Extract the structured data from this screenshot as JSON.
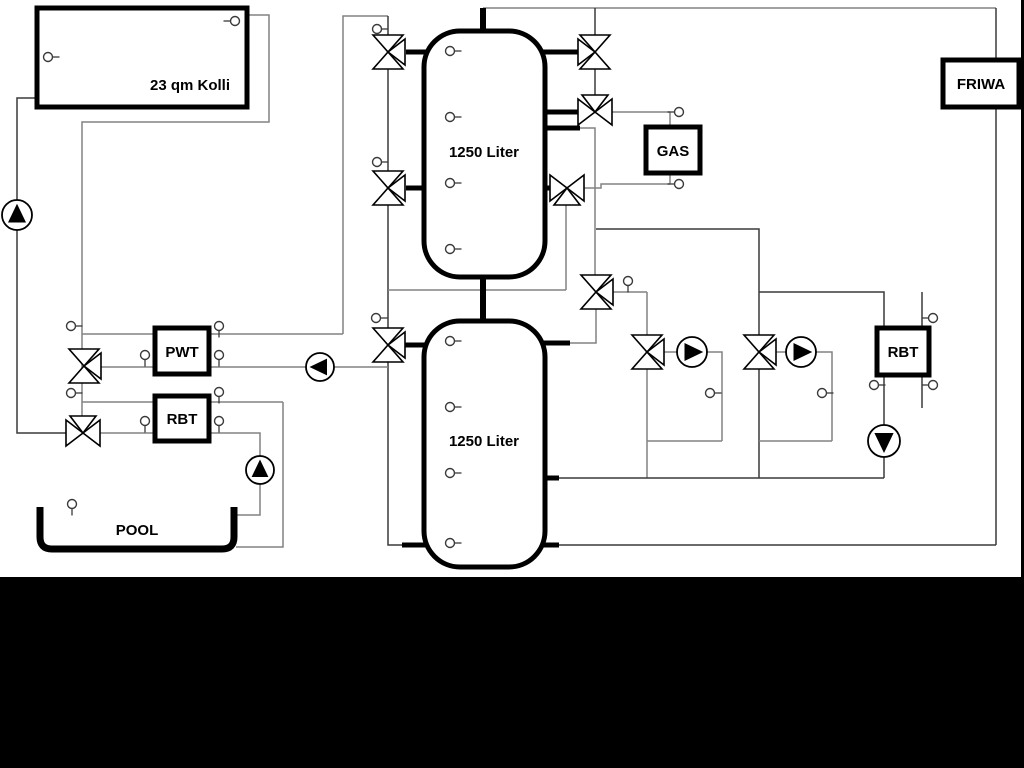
{
  "diagram_title": "Heating system hydraulic schematic",
  "colors": {
    "pipe_gray": "#828282",
    "pipe_dark": "#3a3a3a",
    "black": "#000000",
    "white": "#ffffff"
  },
  "frame": {
    "width": 1024,
    "height": 768,
    "black_band_y": 577,
    "right_strip_x": 1021,
    "right_strip_w": 3
  },
  "boxes": [
    {
      "id": "collector",
      "label": "23 qm Kolli",
      "x": 37,
      "y": 8,
      "w": 210,
      "h": 99,
      "rx": 0,
      "sw": 5,
      "lx": 190,
      "ly": 90,
      "fs": 15
    },
    {
      "id": "tank-upper",
      "label": "1250 Liter",
      "x": 424,
      "y": 31,
      "w": 121,
      "h": 246,
      "rx": 36,
      "sw": 5,
      "lx": 484,
      "ly": 157,
      "fs": 15
    },
    {
      "id": "tank-lower",
      "label": "1250 Liter",
      "x": 424,
      "y": 321,
      "w": 121,
      "h": 246,
      "rx": 36,
      "sw": 5,
      "lx": 484,
      "ly": 446,
      "fs": 15
    },
    {
      "id": "pwt",
      "label": "PWT",
      "x": 155,
      "y": 328,
      "w": 54,
      "h": 46,
      "rx": 0,
      "sw": 5,
      "lx": 182,
      "ly": 357,
      "fs": 15
    },
    {
      "id": "rbt-left",
      "label": "RBT",
      "x": 155,
      "y": 396,
      "w": 54,
      "h": 45,
      "rx": 0,
      "sw": 5,
      "lx": 182,
      "ly": 424,
      "fs": 15
    },
    {
      "id": "gas",
      "label": "GAS",
      "x": 646,
      "y": 127,
      "w": 54,
      "h": 46,
      "rx": 0,
      "sw": 5,
      "lx": 673,
      "ly": 156,
      "fs": 15
    },
    {
      "id": "rbt-right",
      "label": "RBT",
      "x": 877,
      "y": 328,
      "w": 52,
      "h": 47,
      "rx": 0,
      "sw": 5,
      "lx": 903,
      "ly": 357,
      "fs": 15
    },
    {
      "id": "friwa",
      "label": "FRIWA",
      "x": 943,
      "y": 60,
      "w": 76,
      "h": 47,
      "rx": 0,
      "sw": 5,
      "lx": 981,
      "ly": 89,
      "fs": 15
    }
  ],
  "pool": {
    "label": "POOL",
    "x1": 40,
    "x2": 234,
    "top": 507,
    "bottom": 549,
    "r": 12,
    "sw": 7,
    "lx": 137,
    "ly": 535,
    "fs": 15
  },
  "pipes": [
    {
      "name": "solar-return-riser",
      "pts": [
        [
          37,
          98
        ],
        [
          17,
          98
        ],
        [
          17,
          433
        ],
        [
          66,
          433
        ]
      ],
      "c": "d",
      "w": 1.5
    },
    {
      "name": "solar-flow-drop",
      "pts": [
        [
          247,
          15
        ],
        [
          269,
          15
        ],
        [
          269,
          122
        ],
        [
          82,
          122
        ],
        [
          82,
          416
        ]
      ],
      "c": "g",
      "w": 1.5
    },
    {
      "name": "pwt-top-line",
      "pts": [
        [
          82,
          334
        ],
        [
          343,
          334
        ]
      ],
      "c": "g",
      "w": 1.5
    },
    {
      "name": "tank-left-riser",
      "pts": [
        [
          343,
          334
        ],
        [
          343,
          16
        ],
        [
          388,
          16
        ]
      ],
      "c": "g",
      "w": 1.5
    },
    {
      "name": "tank-left-manifold",
      "pts": [
        [
          388,
          16
        ],
        [
          388,
          545
        ],
        [
          403,
          545
        ]
      ],
      "c": "d",
      "w": 1.5
    },
    {
      "name": "pwt-bottom-line",
      "pts": [
        [
          101,
          367
        ],
        [
          388,
          367
        ]
      ],
      "c": "g",
      "w": 1.5
    },
    {
      "name": "rbt-left-top-line",
      "pts": [
        [
          82,
          402
        ],
        [
          283,
          402
        ]
      ],
      "c": "g",
      "w": 1.5
    },
    {
      "name": "pool-return-line",
      "pts": [
        [
          283,
          402
        ],
        [
          283,
          547
        ],
        [
          236,
          547
        ]
      ],
      "c": "g",
      "w": 1.5
    },
    {
      "name": "pool-flow-line",
      "pts": [
        [
          100,
          433
        ],
        [
          260,
          433
        ],
        [
          260,
          515
        ],
        [
          233,
          515
        ]
      ],
      "c": "g",
      "w": 1.5
    },
    {
      "name": "top-header",
      "pts": [
        [
          483,
          8
        ],
        [
          996,
          8
        ]
      ],
      "c": "g",
      "w": 1.5
    },
    {
      "name": "tank1-top-right-drop",
      "pts": [
        [
          595,
          8
        ],
        [
          595,
          95
        ]
      ],
      "c": "d",
      "w": 1.5
    },
    {
      "name": "gas-flow-line",
      "pts": [
        [
          612,
          112
        ],
        [
          670,
          112
        ]
      ],
      "c": "g",
      "w": 1.5
    },
    {
      "name": "gas-top-connector",
      "pts": [
        [
          670,
          112
        ],
        [
          670,
          127
        ]
      ],
      "c": "g",
      "w": 1.5
    },
    {
      "name": "gas-bottom-connector",
      "pts": [
        [
          670,
          173
        ],
        [
          670,
          184
        ]
      ],
      "c": "g",
      "w": 1.5
    },
    {
      "name": "gas-return-line",
      "pts": [
        [
          670,
          184
        ],
        [
          601,
          184
        ],
        [
          601,
          188
        ],
        [
          584,
          188
        ]
      ],
      "c": "g",
      "w": 1.5
    },
    {
      "name": "gas-return-drop",
      "pts": [
        [
          566,
          205
        ],
        [
          566,
          290
        ]
      ],
      "c": "g",
      "w": 1.5
    },
    {
      "name": "mid-return-line",
      "pts": [
        [
          388,
          290
        ],
        [
          566,
          290
        ]
      ],
      "c": "g",
      "w": 1.5
    },
    {
      "name": "tank1-mid-right-drop",
      "pts": [
        [
          580,
          128
        ],
        [
          595,
          128
        ],
        [
          595,
          275
        ]
      ],
      "c": "g",
      "w": 1.5
    },
    {
      "name": "heating-branch",
      "pts": [
        [
          596,
          229
        ],
        [
          759,
          229
        ],
        [
          759,
          478
        ]
      ],
      "c": "d",
      "w": 1.5
    },
    {
      "name": "valve-a-right-line",
      "pts": [
        [
          613,
          292
        ],
        [
          647,
          292
        ]
      ],
      "c": "g",
      "w": 1.5
    },
    {
      "name": "circuit1-riser",
      "pts": [
        [
          647,
          292
        ],
        [
          647,
          478
        ]
      ],
      "c": "g",
      "w": 1.5
    },
    {
      "name": "valve-a-tank-drop",
      "pts": [
        [
          596,
          309
        ],
        [
          596,
          343
        ],
        [
          570,
          343
        ]
      ],
      "c": "g",
      "w": 1.5
    },
    {
      "name": "circuit1-pump-line",
      "pts": [
        [
          664,
          352
        ],
        [
          722,
          352
        ],
        [
          722,
          441
        ]
      ],
      "c": "g",
      "w": 1.5
    },
    {
      "name": "circuit1-loop",
      "pts": [
        [
          647,
          441
        ],
        [
          722,
          441
        ]
      ],
      "c": "g",
      "w": 1.5
    },
    {
      "name": "circuit2-pump-line",
      "pts": [
        [
          776,
          352
        ],
        [
          832,
          352
        ],
        [
          832,
          441
        ]
      ],
      "c": "g",
      "w": 1.5
    },
    {
      "name": "circuit2-loop",
      "pts": [
        [
          759,
          441
        ],
        [
          832,
          441
        ]
      ],
      "c": "g",
      "w": 1.5
    },
    {
      "name": "rbt-right-feed",
      "pts": [
        [
          759,
          292
        ],
        [
          884,
          292
        ],
        [
          884,
          328
        ]
      ],
      "c": "d",
      "w": 1.5
    },
    {
      "name": "rbt-right-drop",
      "pts": [
        [
          884,
          375
        ],
        [
          884,
          426
        ]
      ],
      "c": "d",
      "w": 1.5
    },
    {
      "name": "rbt-pump-drop",
      "pts": [
        [
          884,
          456
        ],
        [
          884,
          478
        ]
      ],
      "c": "d",
      "w": 1.5
    },
    {
      "name": "tank2-upper-return",
      "pts": [
        [
          557,
          478
        ],
        [
          884,
          478
        ]
      ],
      "c": "d",
      "w": 1.5
    },
    {
      "name": "tank2-bottom-line",
      "pts": [
        [
          557,
          545
        ],
        [
          996,
          545
        ]
      ],
      "c": "d",
      "w": 1.5
    },
    {
      "name": "friwa-top-connector",
      "pts": [
        [
          996,
          8
        ],
        [
          996,
          60
        ]
      ],
      "c": "d",
      "w": 1.5
    },
    {
      "name": "friwa-return-riser",
      "pts": [
        [
          996,
          107
        ],
        [
          996,
          545
        ]
      ],
      "c": "d",
      "w": 1.5
    },
    {
      "name": "rbt-right-secondary",
      "pts": [
        [
          922,
          292
        ],
        [
          922,
          408
        ]
      ],
      "c": "d",
      "w": 1.5
    },
    {
      "name": "tank1-top-pipe",
      "pts": [
        [
          483,
          8
        ],
        [
          483,
          31
        ]
      ],
      "c": "k",
      "w": 6
    },
    {
      "name": "tank-interconnect-pipe",
      "pts": [
        [
          483,
          277
        ],
        [
          483,
          321
        ]
      ],
      "c": "k",
      "w": 6
    },
    {
      "name": "stub-t1-left-top",
      "pts": [
        [
          406,
          52
        ],
        [
          426,
          52
        ]
      ],
      "c": "k",
      "w": 5
    },
    {
      "name": "stub-t1-left-bottom",
      "pts": [
        [
          406,
          188
        ],
        [
          426,
          188
        ]
      ],
      "c": "k",
      "w": 5
    },
    {
      "name": "stub-t2-left-top",
      "pts": [
        [
          405,
          345
        ],
        [
          426,
          345
        ]
      ],
      "c": "k",
      "w": 5
    },
    {
      "name": "stub-t2-left-bottom",
      "pts": [
        [
          402,
          545
        ],
        [
          426,
          545
        ]
      ],
      "c": "k",
      "w": 5
    },
    {
      "name": "stub-t1-right-top",
      "pts": [
        [
          543,
          52
        ],
        [
          578,
          52
        ]
      ],
      "c": "k",
      "w": 5
    },
    {
      "name": "stub-t1-right-mid1",
      "pts": [
        [
          543,
          112
        ],
        [
          578,
          112
        ]
      ],
      "c": "k",
      "w": 5
    },
    {
      "name": "stub-t1-right-mid2",
      "pts": [
        [
          543,
          128
        ],
        [
          580,
          128
        ]
      ],
      "c": "k",
      "w": 5
    },
    {
      "name": "stub-t1-right-bottom",
      "pts": [
        [
          543,
          188
        ],
        [
          550,
          188
        ]
      ],
      "c": "k",
      "w": 5
    },
    {
      "name": "stub-t2-right-top",
      "pts": [
        [
          543,
          343
        ],
        [
          570,
          343
        ]
      ],
      "c": "k",
      "w": 5
    },
    {
      "name": "stub-t2-right-mid",
      "pts": [
        [
          543,
          478
        ],
        [
          559,
          478
        ]
      ],
      "c": "k",
      "w": 5
    },
    {
      "name": "stub-t2-right-bottom",
      "pts": [
        [
          543,
          545
        ],
        [
          559,
          545
        ]
      ],
      "c": "k",
      "w": 5
    }
  ],
  "valves": [
    {
      "name": "valve-tank1-top-left",
      "x": 388,
      "y": 52,
      "t": "vr"
    },
    {
      "name": "valve-tank1-bottom-left",
      "x": 388,
      "y": 188,
      "t": "vr"
    },
    {
      "name": "valve-tank2-top-left",
      "x": 388,
      "y": 345,
      "t": "vr"
    },
    {
      "name": "valve-solar-pwt",
      "x": 84,
      "y": 366,
      "t": "vr"
    },
    {
      "name": "valve-solar-pool",
      "x": 83,
      "y": 433,
      "t": "ht"
    },
    {
      "name": "valve-tank1-top-right",
      "x": 595,
      "y": 52,
      "t": "vl"
    },
    {
      "name": "valve-gas-flow",
      "x": 595,
      "y": 112,
      "t": "ht"
    },
    {
      "name": "valve-gas-return",
      "x": 567,
      "y": 188,
      "t": "hb"
    },
    {
      "name": "valve-heating-riser",
      "x": 596,
      "y": 292,
      "t": "vr"
    },
    {
      "name": "valve-heating-circuit-1",
      "x": 647,
      "y": 352,
      "t": "vr"
    },
    {
      "name": "valve-heating-circuit-2",
      "x": 759,
      "y": 352,
      "t": "vr"
    }
  ],
  "pumps": [
    {
      "name": "pump-solar",
      "x": 17,
      "y": 215,
      "r": 15,
      "dir": "up"
    },
    {
      "name": "pump-pwt",
      "x": 320,
      "y": 367,
      "r": 14,
      "dir": "left"
    },
    {
      "name": "pump-pool",
      "x": 260,
      "y": 470,
      "r": 14,
      "dir": "up"
    },
    {
      "name": "pump-circuit-1",
      "x": 692,
      "y": 352,
      "r": 15,
      "dir": "right"
    },
    {
      "name": "pump-circuit-2",
      "x": 801,
      "y": 352,
      "r": 15,
      "dir": "right"
    },
    {
      "name": "pump-rbt-right",
      "x": 884,
      "y": 441,
      "r": 16,
      "dir": "down"
    }
  ],
  "sensors": [
    {
      "name": "sensor-collector-flow",
      "x": 235,
      "y": 21,
      "t": "l"
    },
    {
      "name": "sensor-collector-plate",
      "x": 48,
      "y": 57,
      "t": "r"
    },
    {
      "name": "sensor-pwt-top-left",
      "x": 71,
      "y": 326,
      "t": "r"
    },
    {
      "name": "sensor-rbt-top-left",
      "x": 71,
      "y": 393,
      "t": "r"
    },
    {
      "name": "sensor-pwt-left",
      "x": 145,
      "y": 355,
      "t": "d"
    },
    {
      "name": "sensor-pwt-right-top",
      "x": 219,
      "y": 326,
      "t": "d"
    },
    {
      "name": "sensor-pwt-right",
      "x": 219,
      "y": 355,
      "t": "d"
    },
    {
      "name": "sensor-rbt-right-top",
      "x": 219,
      "y": 392,
      "t": "d"
    },
    {
      "name": "sensor-rbt-left",
      "x": 145,
      "y": 421,
      "t": "d"
    },
    {
      "name": "sensor-rbt-right",
      "x": 219,
      "y": 421,
      "t": "d"
    },
    {
      "name": "sensor-pool",
      "x": 72,
      "y": 504,
      "t": "d"
    },
    {
      "name": "sensor-manifold-top",
      "x": 377,
      "y": 29,
      "t": "r"
    },
    {
      "name": "sensor-manifold-mid",
      "x": 377,
      "y": 162,
      "t": "r"
    },
    {
      "name": "sensor-manifold-low",
      "x": 376,
      "y": 318,
      "t": "r"
    },
    {
      "name": "sensor-tank1-1",
      "x": 450,
      "y": 51,
      "t": "r"
    },
    {
      "name": "sensor-tank1-2",
      "x": 450,
      "y": 117,
      "t": "r"
    },
    {
      "name": "sensor-tank1-3",
      "x": 450,
      "y": 183,
      "t": "r"
    },
    {
      "name": "sensor-tank1-4",
      "x": 450,
      "y": 249,
      "t": "r"
    },
    {
      "name": "sensor-tank2-1",
      "x": 450,
      "y": 341,
      "t": "r"
    },
    {
      "name": "sensor-tank2-2",
      "x": 450,
      "y": 407,
      "t": "r"
    },
    {
      "name": "sensor-tank2-3",
      "x": 450,
      "y": 473,
      "t": "r"
    },
    {
      "name": "sensor-tank2-4",
      "x": 450,
      "y": 543,
      "t": "r"
    },
    {
      "name": "sensor-gas-flow",
      "x": 679,
      "y": 112,
      "t": "l"
    },
    {
      "name": "sensor-gas-return",
      "x": 679,
      "y": 184,
      "t": "l"
    },
    {
      "name": "sensor-heating-flow",
      "x": 628,
      "y": 281,
      "t": "d"
    },
    {
      "name": "sensor-circuit-1",
      "x": 710,
      "y": 393,
      "t": "r"
    },
    {
      "name": "sensor-circuit-2",
      "x": 822,
      "y": 393,
      "t": "r"
    },
    {
      "name": "sensor-rbt-right-return",
      "x": 874,
      "y": 385,
      "t": "r"
    },
    {
      "name": "sensor-rbt-sec-top",
      "x": 933,
      "y": 318,
      "t": "l"
    },
    {
      "name": "sensor-rbt-sec-bottom",
      "x": 933,
      "y": 385,
      "t": "l"
    }
  ]
}
